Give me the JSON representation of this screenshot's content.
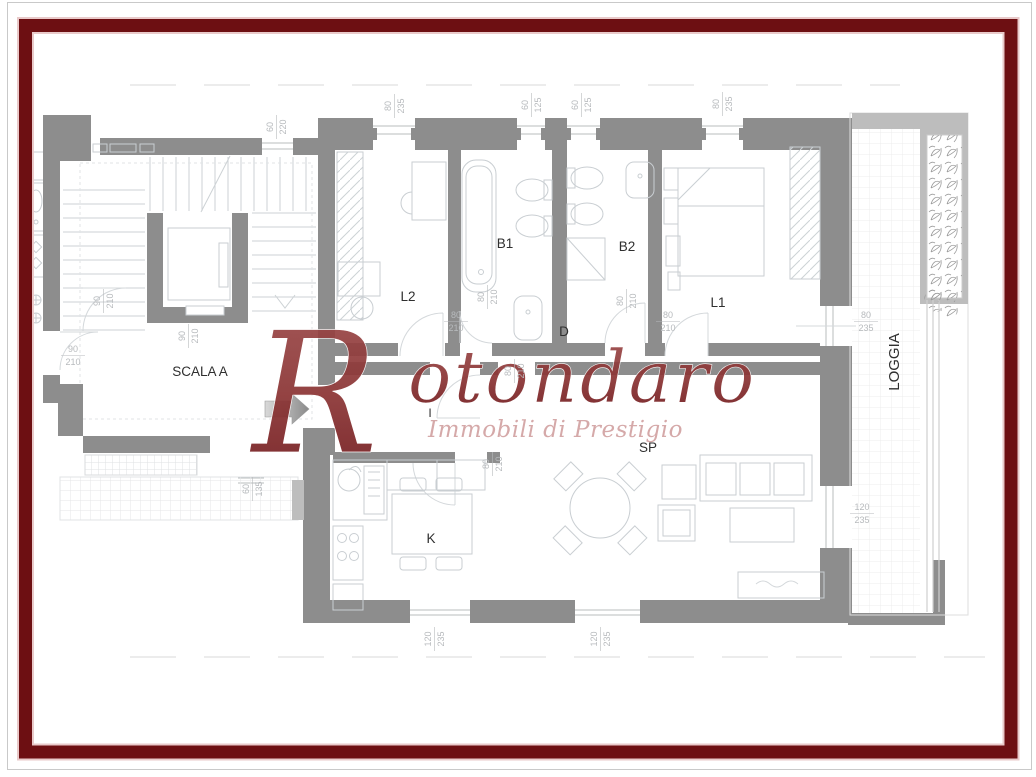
{
  "brand": {
    "wordmark_initial": "R",
    "wordmark_rest": "otondaro",
    "wordmark": "Rotondaro",
    "tagline": "Immobili di Prestigio"
  },
  "colors": {
    "frame_accent": "#6d0f12",
    "frame_glow": "#e9caca",
    "outer_hairline": "#c9c9c9",
    "wall": "#8d8d8d",
    "wall_light": "#bdbdbd",
    "furniture_line": "#c9ced2",
    "stair_line": "#cdd2d5",
    "tile_line": "#ececec",
    "dimension_text": "#b7babd",
    "room_label_text": "#2f2f2f",
    "watermark_red_dark": "#6d1519",
    "watermark_red_light": "#9c4a4a",
    "watermark_tagline": "#d2a2a2",
    "arrow_gray": "#9a9a9a"
  },
  "rooms": [
    {
      "id": "scala-a",
      "label": "SCALA A",
      "x": 200,
      "y": 376,
      "rot": 0,
      "size": 13.5
    },
    {
      "id": "l2",
      "label": "L2",
      "x": 408,
      "y": 301,
      "rot": 0,
      "size": 13.5
    },
    {
      "id": "b1",
      "label": "B1",
      "x": 505,
      "y": 248,
      "rot": 0,
      "size": 13.5
    },
    {
      "id": "b2",
      "label": "B2",
      "x": 627,
      "y": 251,
      "rot": 0,
      "size": 13.5
    },
    {
      "id": "l1",
      "label": "L1",
      "x": 718,
      "y": 307,
      "rot": 0,
      "size": 13.5
    },
    {
      "id": "d",
      "label": "D",
      "x": 564,
      "y": 336,
      "rot": 0,
      "size": 13.5
    },
    {
      "id": "i",
      "label": "I",
      "x": 430,
      "y": 417,
      "rot": 0,
      "size": 12
    },
    {
      "id": "sp",
      "label": "SP",
      "x": 648,
      "y": 452,
      "rot": 0,
      "size": 13.5
    },
    {
      "id": "k",
      "label": "K",
      "x": 431,
      "y": 543,
      "rot": 0,
      "size": 13.5
    },
    {
      "id": "loggia",
      "label": "LOGGIA",
      "x": 899,
      "y": 362,
      "rot": -90,
      "size": 15
    }
  ],
  "dimensions": [
    {
      "w": "60",
      "h": "220",
      "x": 276,
      "y": 127,
      "rot": -90
    },
    {
      "w": "80",
      "h": "235",
      "x": 394,
      "y": 106,
      "rot": -90
    },
    {
      "w": "60",
      "h": "125",
      "x": 531,
      "y": 105,
      "rot": -90
    },
    {
      "w": "60",
      "h": "125",
      "x": 581,
      "y": 105,
      "rot": -90
    },
    {
      "w": "80",
      "h": "235",
      "x": 722,
      "y": 104,
      "rot": -90
    },
    {
      "w": "90",
      "h": "210",
      "x": 103,
      "y": 301,
      "rot": -90
    },
    {
      "w": "90",
      "h": "210",
      "x": 188,
      "y": 336,
      "rot": -90
    },
    {
      "w": "90",
      "h": "210",
      "x": 73,
      "y": 355,
      "rot": 0
    },
    {
      "w": "80",
      "h": "210",
      "x": 456,
      "y": 321,
      "rot": 0
    },
    {
      "w": "80",
      "h": "210",
      "x": 487,
      "y": 297,
      "rot": -90
    },
    {
      "w": "80",
      "h": "210",
      "x": 626,
      "y": 301,
      "rot": -90
    },
    {
      "w": "80",
      "h": "210",
      "x": 668,
      "y": 321,
      "rot": 0
    },
    {
      "w": "80",
      "h": "210",
      "x": 514,
      "y": 371,
      "rot": -90
    },
    {
      "w": "80",
      "h": "210",
      "x": 492,
      "y": 464,
      "rot": -90
    },
    {
      "w": "80",
      "h": "235",
      "x": 866,
      "y": 321,
      "rot": 0
    },
    {
      "w": "120",
      "h": "235",
      "x": 862,
      "y": 513,
      "rot": 0
    },
    {
      "w": "120",
      "h": "235",
      "x": 434,
      "y": 639,
      "rot": -90
    },
    {
      "w": "120",
      "h": "235",
      "x": 600,
      "y": 639,
      "rot": -90
    },
    {
      "w": "60",
      "h": "135",
      "x": 252,
      "y": 489,
      "rot": -90
    }
  ]
}
